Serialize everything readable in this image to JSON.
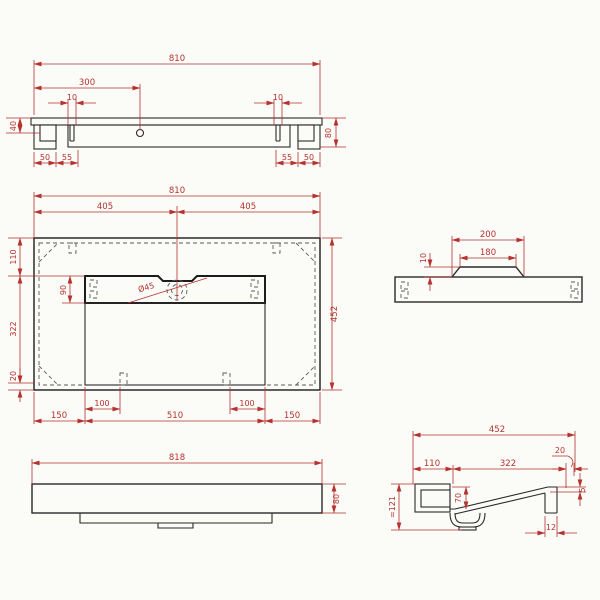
{
  "drawing": {
    "colors": {
      "dimension": "#b5322e",
      "outline": "#2a2a2a",
      "background": "#fbfbf8"
    },
    "front_view": {
      "width": "810",
      "tap_offset": "300",
      "slot_left": "10",
      "slot_right": "10",
      "bracket_height": "40",
      "total_height": "80",
      "left_outer": "50",
      "left_inner": "55",
      "right_inner": "55",
      "right_outer": "50"
    },
    "plan_view": {
      "width": "810",
      "left_half": "405",
      "right_half": "405",
      "depth": "452",
      "back": "110",
      "basin_length": "322",
      "front": "20",
      "channel_depth": "90",
      "drain_diameter": "Ø45",
      "bottom_left": "150",
      "slot_left": "100",
      "center": "510",
      "slot_right": "100",
      "bottom_right": "150"
    },
    "bracket_section_view": {
      "outer": "200",
      "inner": "180",
      "height": "10"
    },
    "bottom_view": {
      "width": "818",
      "height": "80"
    },
    "side_view": {
      "depth": "452",
      "back": "110",
      "basin": "322",
      "edge": "20",
      "bowl_depth": "70",
      "total_height": "=121",
      "rim": "5",
      "wall": "12"
    }
  }
}
